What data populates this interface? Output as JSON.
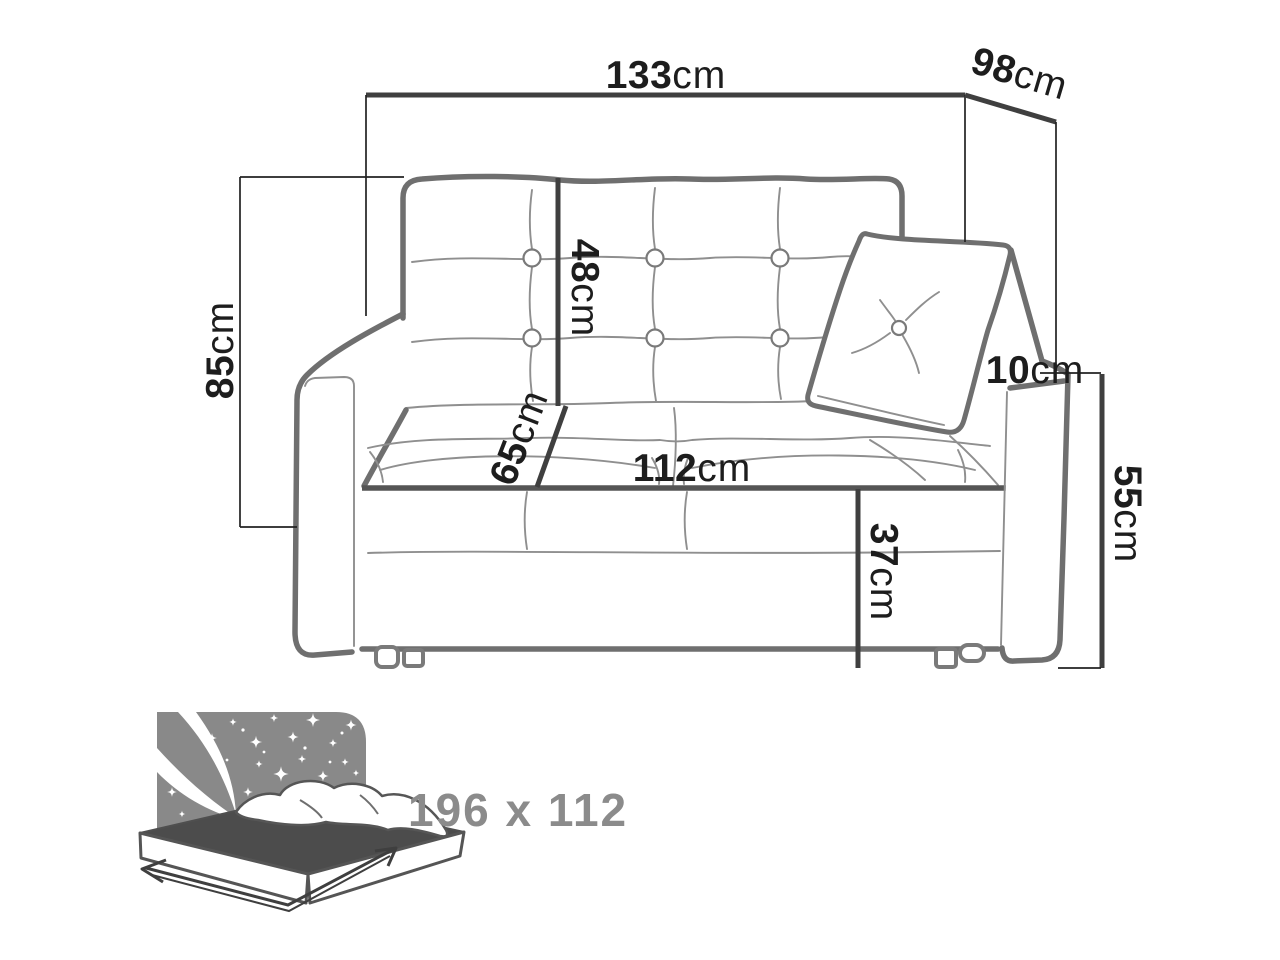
{
  "diagram": {
    "type": "sofa-bed dimension drawing",
    "dimensions": {
      "top_width": {
        "value": "133",
        "unit": "cm"
      },
      "depth": {
        "value": "98",
        "unit": "cm"
      },
      "total_height": {
        "value": "85",
        "unit": "cm"
      },
      "backrest_height": {
        "value": "48",
        "unit": "cm"
      },
      "seat_depth": {
        "value": "65",
        "unit": "cm"
      },
      "seat_width": {
        "value": "112",
        "unit": "cm"
      },
      "seat_height": {
        "value": "37",
        "unit": "cm"
      },
      "armrest_top_width": {
        "value": "10",
        "unit": "cm"
      },
      "armrest_height": {
        "value": "55",
        "unit": "cm"
      }
    },
    "sleeping_area": {
      "label": "196 x 112"
    },
    "colors": {
      "background": "#ffffff",
      "dimension_line": "#3f3f3f",
      "dimension_text": "#1d1d1d",
      "sofa_outline": "#6f6f6f",
      "sofa_crease": "#8f8f8f",
      "bed_icon_gray": "#898989",
      "bed_mattress_top": "#4c4c4c",
      "bed_label_text": "#8b8b8b"
    }
  }
}
